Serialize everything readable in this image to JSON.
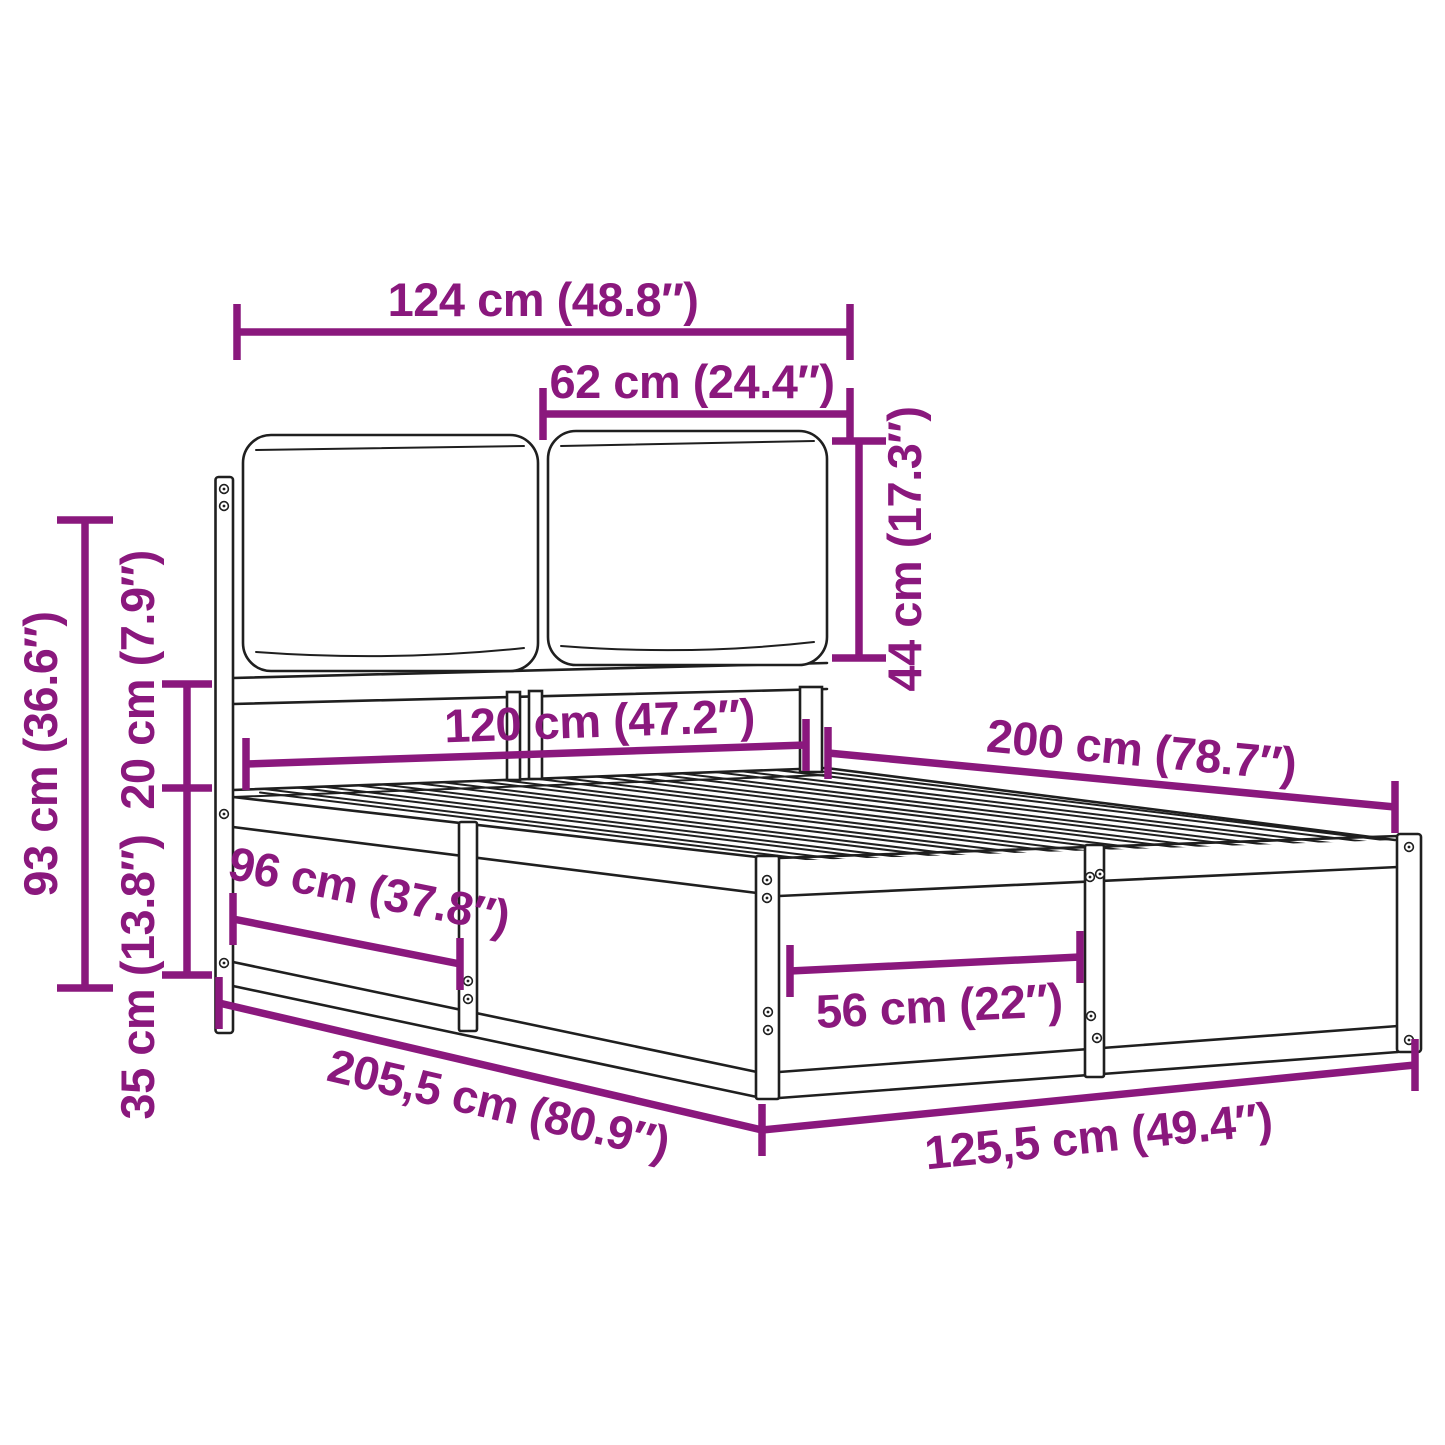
{
  "diagram": {
    "type": "furniture-dimension-diagram",
    "subject": "bed frame with headboard cushions",
    "background_color": "#ffffff",
    "dimension_color": "#8a187d",
    "artwork_color": "#1f1f1f",
    "dimensions": {
      "headboard_width_total": "124 cm (48.8″)",
      "cushion_width": "62 cm (24.4″)",
      "cushion_height": "44 cm (17.3″)",
      "headboard_height": "93 cm (36.6″)",
      "rail_to_cushion_gap": "20 cm (7.9″)",
      "base_height": "35 cm (13.8″)",
      "bed_inner_width": "120 cm (47.2″)",
      "bed_inner_length": "200 cm (78.7″)",
      "side_section_length": "96 cm (37.8″)",
      "end_panel_section": "56 cm (22″)",
      "outer_length": "205,5 cm (80.9″)",
      "outer_width": "125,5 cm (49.4″)"
    }
  }
}
